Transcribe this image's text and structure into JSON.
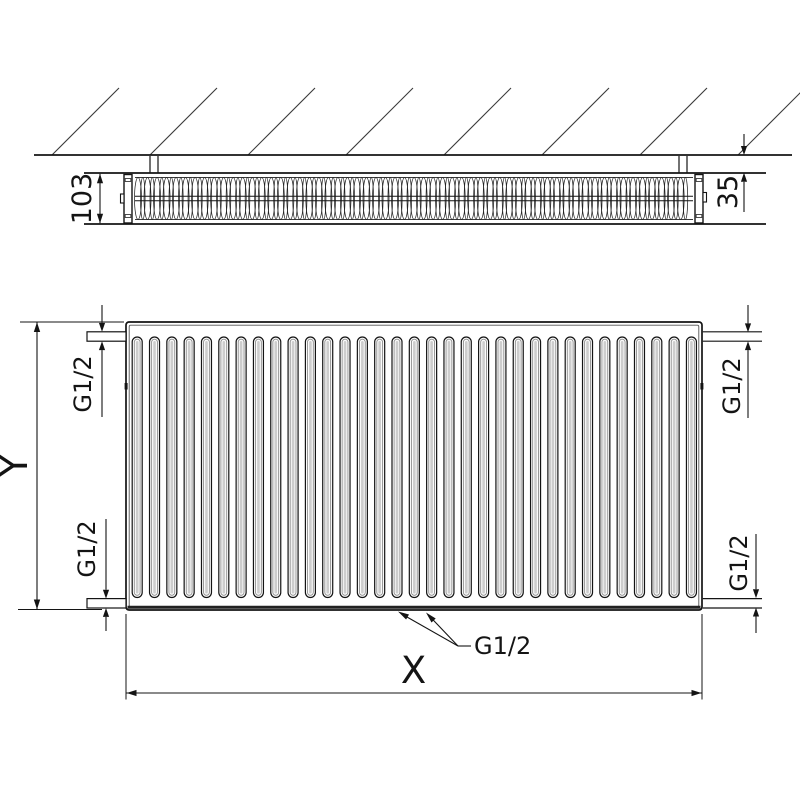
{
  "drawing": {
    "type": "Panel radiator technical installation drawing, top view and front view",
    "labels": {
      "depth": "103",
      "wall_clearance": "35",
      "height": "Y",
      "width": "X",
      "thread_top_left": "G1/2",
      "thread_bottom_left": "G1/2",
      "thread_top_right": "G1/2",
      "thread_bottom_right": "G1/2",
      "thread_bottom_center": "G1/2"
    },
    "figure": {
      "front_groove_count": 33,
      "convector_fin_count": 116,
      "wall_hatch_count": 8,
      "colors": {
        "line": "#141414",
        "thin_line": "#3a3a3a",
        "background": "#ffffff",
        "groove_fill": "#fbfbfb",
        "groove_inner_stroke": "#8a8a8a",
        "groove_center": "#cdcdcd"
      }
    }
  }
}
